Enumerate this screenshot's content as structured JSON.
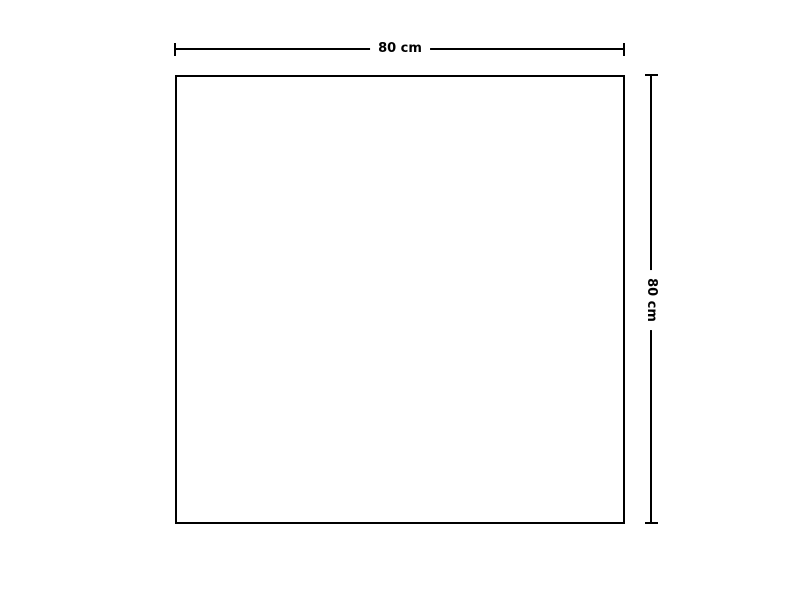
{
  "diagram": {
    "shape": "square-outline",
    "top_dimension": {
      "label": "80 cm"
    },
    "right_dimension": {
      "label": "80 cm"
    },
    "colors": {
      "line": "#000000",
      "background": "#ffffff",
      "text": "#000000"
    }
  }
}
